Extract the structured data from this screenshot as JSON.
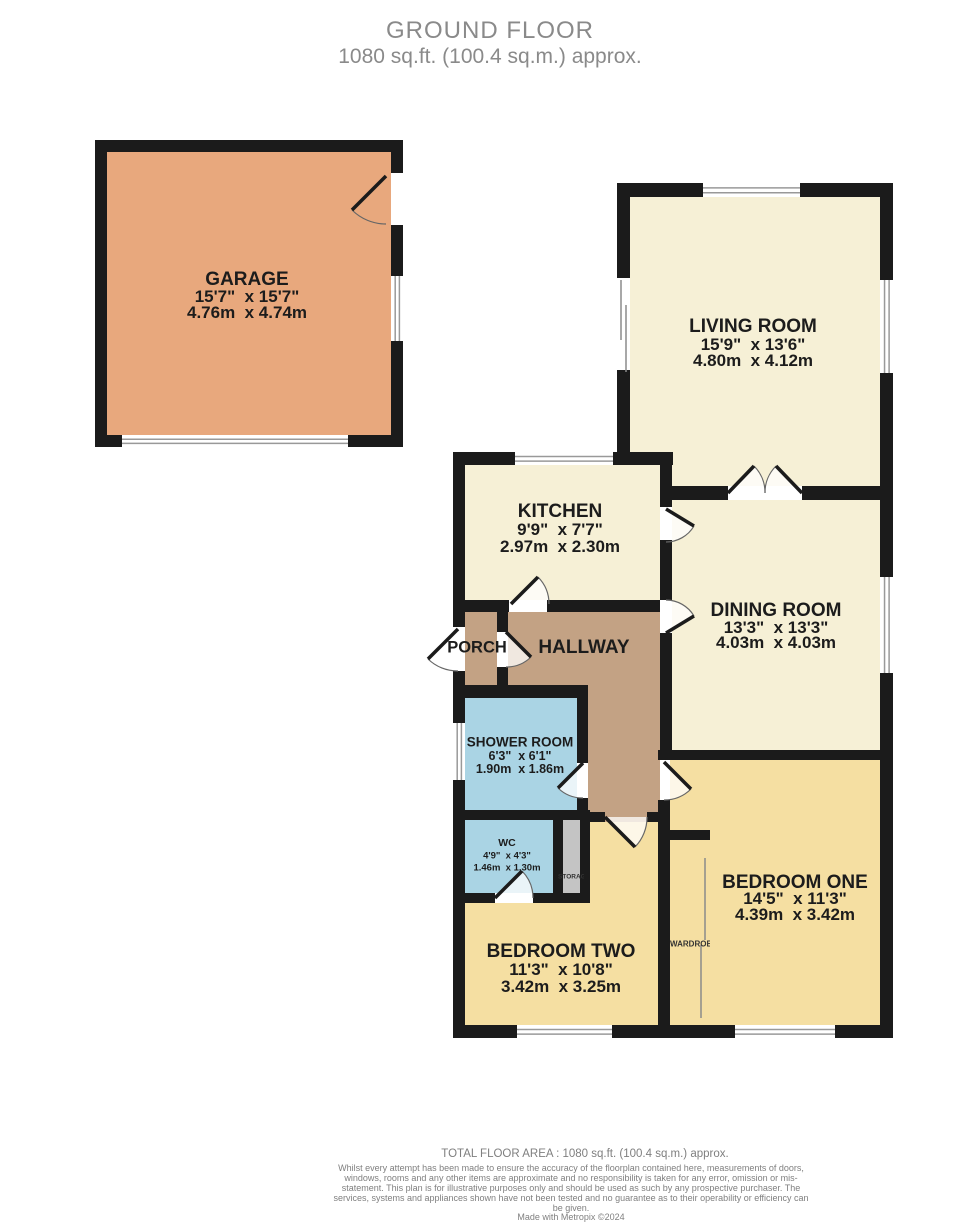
{
  "header": {
    "title": "GROUND FLOOR",
    "subtitle": "1080 sq.ft. (100.4 sq.m.) approx."
  },
  "footer": {
    "total_area": "TOTAL FLOOR AREA : 1080 sq.ft. (100.4 sq.m.) approx.",
    "disclaimer": "Whilst every attempt has been made to ensure the accuracy of the floorplan contained here, measurements of doors, windows, rooms and any other items are approximate and no responsibility is taken for any error, omission or mis-statement. This plan is for illustrative purposes only and should be used as such by any prospective purchaser. The services, systems and appliances shown have not been tested and no guarantee as to their operability or efficiency can be given.",
    "credit": "Made with Metropix ©2024"
  },
  "colors": {
    "wall": "#1b1b1b",
    "cream": "#f6f0d6",
    "tan": "#c3a284",
    "orange": "#e8a87d",
    "blue": "#aad4e4",
    "yellow": "#f5dfa2",
    "gray": "#c4c4c4",
    "window_line": "#999999",
    "door_arc": "#666666",
    "label": "#1c1c1c",
    "small_label": "#333333",
    "title": "#8a8a8a",
    "footer": "#7f7f7f"
  },
  "rooms": [
    {
      "id": "garage",
      "name": "GARAGE",
      "imperial": "15'7\"  x 15'7\"",
      "metric": "4.76m  x 4.74m",
      "cx": 247,
      "ny": 280,
      "iy": 297,
      "my": 313,
      "ns": 19,
      "ds": 17
    },
    {
      "id": "living-room",
      "name": "LIVING ROOM",
      "imperial": "15'9\"  x 13'6\"",
      "metric": "4.80m  x 4.12m",
      "cx": 753,
      "ny": 327,
      "iy": 345,
      "my": 361,
      "ns": 19,
      "ds": 17
    },
    {
      "id": "kitchen",
      "name": "KITCHEN",
      "imperial": "9'9\"  x 7'7\"",
      "metric": "2.97m  x 2.30m",
      "cx": 560,
      "ny": 512,
      "iy": 530,
      "my": 547,
      "ns": 19,
      "ds": 17
    },
    {
      "id": "dining-room",
      "name": "DINING ROOM",
      "imperial": "13'3\"  x 13'3\"",
      "metric": "4.03m  x 4.03m",
      "cx": 776,
      "ny": 611,
      "iy": 628,
      "my": 643,
      "ns": 19,
      "ds": 17
    },
    {
      "id": "porch",
      "name": "PORCH",
      "cx": 477,
      "ny": 648,
      "ns": 16.5,
      "ds": 0
    },
    {
      "id": "hallway",
      "name": "HALLWAY",
      "cx": 584,
      "ny": 648,
      "ns": 19,
      "ds": 0
    },
    {
      "id": "shower-room",
      "name": "SHOWER ROOM",
      "imperial": "6'3\"  x 6'1\"",
      "metric": "1.90m  x 1.86m",
      "cx": 520,
      "ny": 742,
      "iy": 756,
      "my": 769,
      "ns": 13.5,
      "ds": 12.5
    },
    {
      "id": "wc",
      "name": "WC",
      "imperial": "4'9\"  x 4'3\"",
      "metric": "1.46m  x 1.30m",
      "cx": 507,
      "ny": 843,
      "iy": 856,
      "my": 868,
      "ns": 10.5,
      "ds": 9.5
    },
    {
      "id": "bedroom-two",
      "name": "BEDROOM TWO",
      "imperial": "11'3\"  x 10'8\"",
      "metric": "3.42m  x 3.25m",
      "cx": 561,
      "ny": 952,
      "iy": 970,
      "my": 987,
      "ns": 19,
      "ds": 17
    },
    {
      "id": "bedroom-one",
      "name": "BEDROOM ONE",
      "imperial": "14'5\"  x 11'3\"",
      "metric": "4.39m  x 3.42m",
      "cx": 795,
      "ny": 883,
      "iy": 899,
      "my": 915,
      "ns": 19,
      "ds": 17
    }
  ],
  "small_labels": [
    {
      "id": "storage",
      "name": "STORAGE",
      "cx": 571,
      "cy": 877,
      "fs": 6.5,
      "clip_w": 26
    },
    {
      "id": "wardrobe",
      "name": "WARDROBE",
      "cx": 690,
      "cy": 944,
      "fs": 8,
      "clip_w": 40
    }
  ],
  "geometry": {
    "fills": [
      {
        "color": "orange",
        "rects": [
          [
            107,
            152,
            284,
            283
          ]
        ]
      },
      {
        "color": "cream",
        "rects": [
          [
            630,
            197,
            250,
            255
          ],
          [
            662,
            452,
            218,
            34
          ],
          [
            465,
            465,
            195,
            135
          ],
          [
            672,
            500,
            208,
            250
          ]
        ]
      },
      {
        "color": "tan",
        "rects": [
          [
            465,
            612,
            32,
            75
          ],
          [
            508,
            612,
            152,
            86
          ],
          [
            588,
            698,
            72,
            124
          ]
        ]
      },
      {
        "color": "blue",
        "rects": [
          [
            465,
            698,
            112,
            112
          ],
          [
            465,
            820,
            88,
            73
          ]
        ]
      },
      {
        "color": "gray",
        "rects": [
          [
            563,
            820,
            17,
            73
          ],
          [
            670,
            840,
            40,
            185
          ]
        ]
      },
      {
        "color": "yellow",
        "rects": [
          [
            465,
            903,
            195,
            122
          ],
          [
            590,
            822,
            70,
            81
          ],
          [
            670,
            760,
            210,
            265
          ]
        ]
      }
    ],
    "walls": [
      [
        95,
        140,
        308,
        12
      ],
      [
        95,
        140,
        12,
        307
      ],
      [
        95,
        435,
        27,
        12
      ],
      [
        348,
        435,
        55,
        12
      ],
      [
        391,
        140,
        12,
        33
      ],
      [
        391,
        225,
        12,
        51
      ],
      [
        391,
        341,
        12,
        106
      ],
      [
        617,
        183,
        86,
        14
      ],
      [
        800,
        183,
        93,
        14
      ],
      [
        880,
        197,
        13,
        83
      ],
      [
        880,
        373,
        13,
        204
      ],
      [
        880,
        673,
        13,
        365
      ],
      [
        617,
        197,
        13,
        81
      ],
      [
        617,
        370,
        13,
        82
      ],
      [
        617,
        452,
        56,
        13
      ],
      [
        453,
        452,
        62,
        13
      ],
      [
        613,
        452,
        60,
        13
      ],
      [
        453,
        452,
        12,
        160
      ],
      [
        453,
        600,
        56,
        12
      ],
      [
        547,
        600,
        113,
        12
      ],
      [
        453,
        612,
        12,
        15
      ],
      [
        453,
        671,
        12,
        27
      ],
      [
        453,
        685,
        135,
        13
      ],
      [
        497,
        612,
        11,
        20
      ],
      [
        497,
        667,
        11,
        18
      ],
      [
        453,
        698,
        12,
        25
      ],
      [
        453,
        780,
        12,
        123
      ],
      [
        577,
        685,
        11,
        78
      ],
      [
        577,
        798,
        11,
        22
      ],
      [
        453,
        810,
        137,
        10
      ],
      [
        553,
        820,
        10,
        73
      ],
      [
        580,
        820,
        10,
        73
      ],
      [
        453,
        893,
        42,
        10
      ],
      [
        533,
        893,
        57,
        10
      ],
      [
        453,
        903,
        12,
        135
      ],
      [
        453,
        1025,
        64,
        13
      ],
      [
        612,
        1025,
        123,
        13
      ],
      [
        835,
        1025,
        58,
        13
      ],
      [
        588,
        812,
        17,
        10
      ],
      [
        647,
        812,
        13,
        10
      ],
      [
        660,
        452,
        12,
        55
      ],
      [
        660,
        540,
        12,
        60
      ],
      [
        660,
        633,
        12,
        117
      ],
      [
        658,
        750,
        235,
        10
      ],
      [
        658,
        800,
        12,
        238
      ],
      [
        662,
        486,
        66,
        14
      ],
      [
        802,
        486,
        91,
        14
      ],
      [
        670,
        830,
        40,
        10
      ]
    ],
    "windows": [
      {
        "x": 703,
        "y": 183,
        "w": 97,
        "h": 14,
        "o": "h"
      },
      {
        "x": 880,
        "y": 280,
        "w": 13,
        "h": 93,
        "o": "v"
      },
      {
        "x": 617,
        "y": 278,
        "w": 13,
        "h": 92,
        "o": "v",
        "plain": true
      },
      {
        "x": 515,
        "y": 452,
        "w": 98,
        "h": 13,
        "o": "h"
      },
      {
        "x": 880,
        "y": 577,
        "w": 13,
        "h": 96,
        "o": "v"
      },
      {
        "x": 453,
        "y": 723,
        "w": 12,
        "h": 57,
        "o": "v"
      },
      {
        "x": 517,
        "y": 1025,
        "w": 95,
        "h": 13,
        "o": "h"
      },
      {
        "x": 735,
        "y": 1025,
        "w": 100,
        "h": 13,
        "o": "h"
      },
      {
        "x": 391,
        "y": 276,
        "w": 12,
        "h": 65,
        "o": "v"
      },
      {
        "x": 122,
        "y": 435,
        "w": 226,
        "h": 12,
        "o": "h"
      }
    ],
    "thin_lines": [
      [
        621,
        280,
        621,
        340
      ],
      [
        626,
        305,
        626,
        372
      ],
      [
        705,
        858,
        705,
        940
      ],
      [
        701,
        945,
        701,
        1018
      ]
    ],
    "doors": [
      {
        "id": "garage-side-door",
        "hinge": [
          386,
          176
        ],
        "tip": [
          352,
          210
        ],
        "end": [
          386,
          224
        ],
        "sweep": 0,
        "fill": false
      },
      {
        "id": "kitchen-hallway-door",
        "hinge": [
          511,
          604
        ],
        "tip": [
          538,
          577
        ],
        "end": [
          549,
          604
        ],
        "sweep": 1,
        "fill": true
      },
      {
        "id": "front-door",
        "hinge": [
          458,
          629
        ],
        "tip": [
          428,
          659
        ],
        "end": [
          458,
          671
        ],
        "sweep": 0,
        "fill": true
      },
      {
        "id": "porch-hallway-door",
        "hinge": [
          506,
          632
        ],
        "tip": [
          531,
          657
        ],
        "end": [
          506,
          667
        ],
        "sweep": 1,
        "fill": true
      },
      {
        "id": "kitchen-dining-door",
        "hinge": [
          666,
          509
        ],
        "tip": [
          694,
          526
        ],
        "end": [
          666,
          542
        ],
        "sweep": 1,
        "fill": true
      },
      {
        "id": "hallway-dining-door",
        "hinge": [
          666,
          633
        ],
        "tip": [
          694,
          616
        ],
        "end": [
          666,
          600
        ],
        "sweep": 0,
        "fill": true
      },
      {
        "id": "shower-room-door",
        "hinge": [
          583,
          763
        ],
        "tip": [
          558,
          788
        ],
        "end": [
          583,
          798
        ],
        "sweep": 0,
        "fill": true
      },
      {
        "id": "wc-door",
        "hinge": [
          495,
          898
        ],
        "tip": [
          522,
          871
        ],
        "end": [
          533,
          898
        ],
        "sweep": 1,
        "fill": true
      },
      {
        "id": "hallway-bedroom-two-door",
        "hinge": [
          605,
          817
        ],
        "tip": [
          635,
          847
        ],
        "end": [
          647,
          817
        ],
        "sweep": 0,
        "fill": true
      },
      {
        "id": "hallway-bedroom-one-door",
        "hinge": [
          664,
          762
        ],
        "tip": [
          691,
          789
        ],
        "end": [
          664,
          800
        ],
        "sweep": 1,
        "fill": true
      },
      {
        "id": "living-dining-double-door-left",
        "hinge": [
          728,
          493
        ],
        "tip": [
          754,
          466
        ],
        "end": [
          765,
          493
        ],
        "sweep": 1,
        "fill": true
      },
      {
        "id": "living-dining-double-door-right",
        "hinge": [
          802,
          493
        ],
        "tip": [
          776,
          466
        ],
        "end": [
          765,
          493
        ],
        "sweep": 0,
        "fill": true
      }
    ]
  }
}
